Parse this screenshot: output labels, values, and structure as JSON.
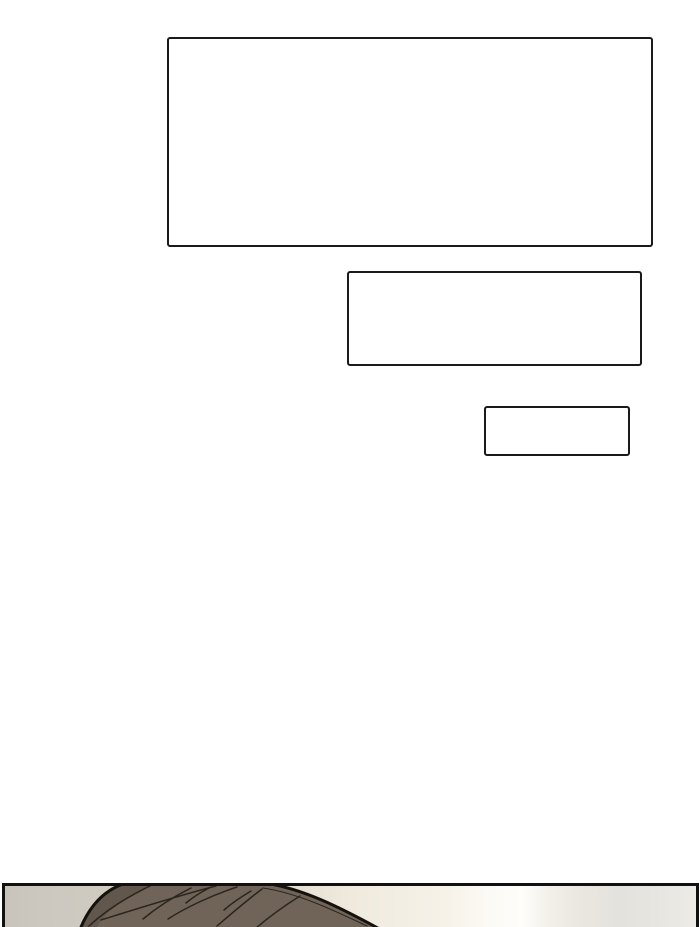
{
  "comic_page": {
    "background_color": "#ffffff",
    "speech_boxes": [
      {
        "name": "large-speech-box",
        "text": ""
      },
      {
        "name": "medium-speech-box",
        "text": ""
      },
      {
        "name": "small-speech-box",
        "text": ""
      }
    ],
    "speech_box_style": {
      "fill": "#ffffff",
      "border_color": "#1a1a1a"
    },
    "bottom_panel": {
      "border_color": "#111111",
      "background_bands": [
        "#c8c4bc",
        "#d2ccc2",
        "#efe9dd",
        "#fefdfb",
        "#eae7e0",
        "#e4e2dd",
        "#edebe6"
      ],
      "character_head": {
        "hair_color": "#6f6457",
        "hair_shadow_color": "#5c5345",
        "hair_strand_color": "#241f18",
        "outline_color": "#15120d"
      }
    }
  }
}
